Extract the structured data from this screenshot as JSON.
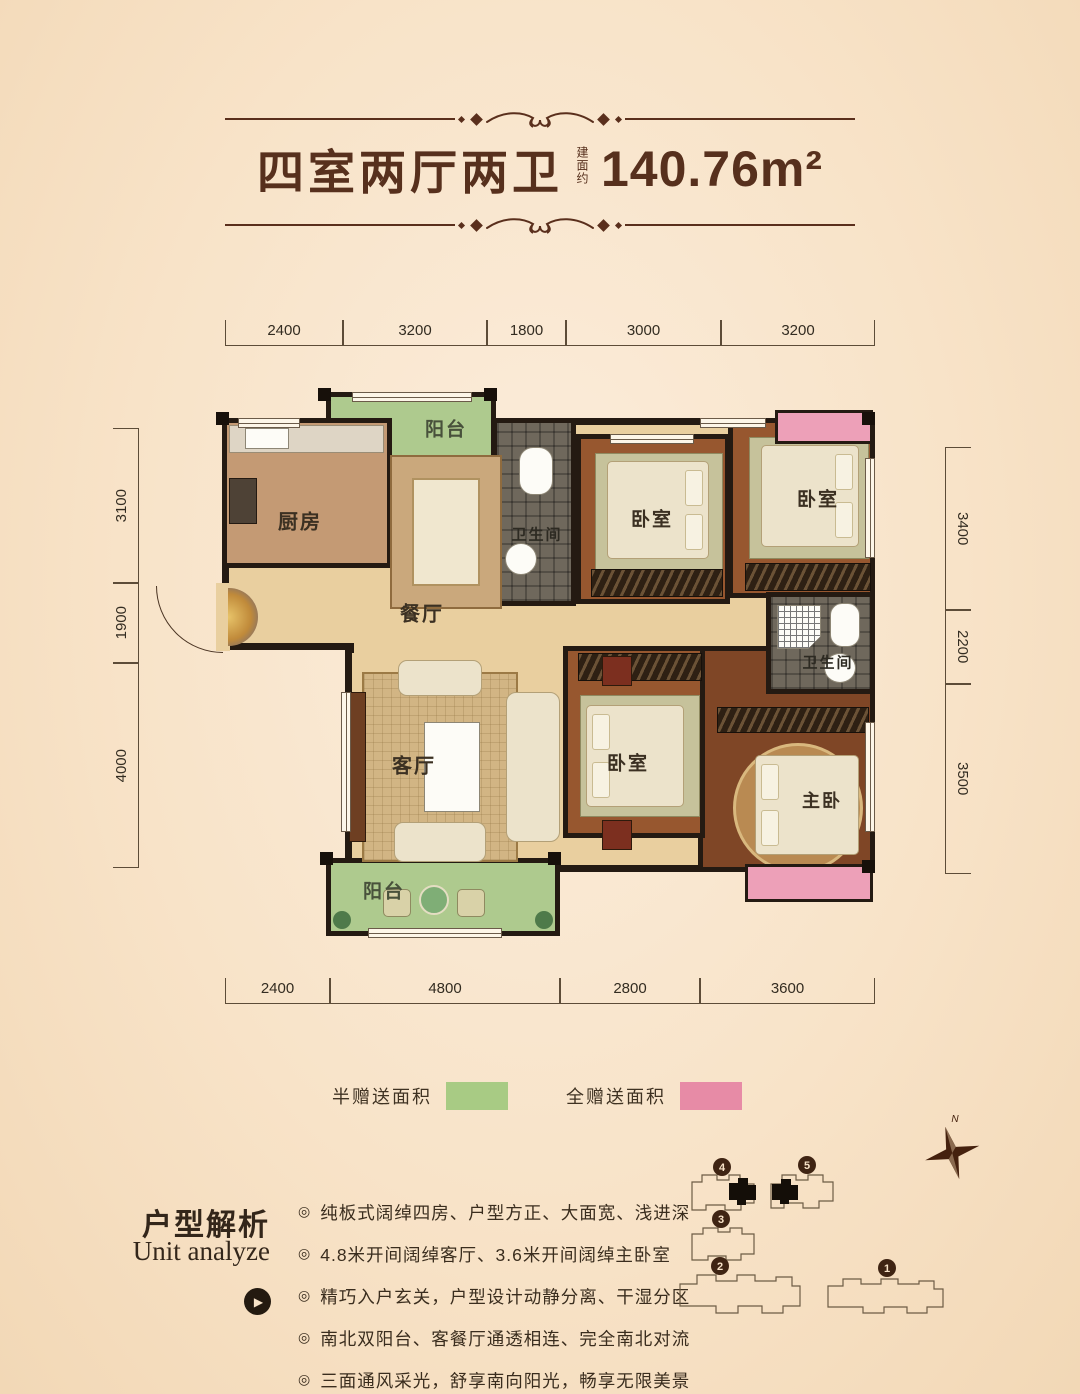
{
  "header": {
    "title_cn": "四室两厅两卫",
    "area_label": "建面约",
    "area_value": "140.76m²"
  },
  "dimensions": {
    "top": [
      "2400",
      "3200",
      "1800",
      "3000",
      "3200"
    ],
    "bottom": [
      "2400",
      "4800",
      "2800",
      "3600"
    ],
    "left": [
      "3100",
      "1900",
      "4000"
    ],
    "right": [
      "3400",
      "2200",
      "3500"
    ]
  },
  "rooms": {
    "balcony_top": "阳台",
    "kitchen": "厨房",
    "dining": "餐厅",
    "bathroom1": "卫生间",
    "bedroom1": "卧室",
    "bedroom2": "卧室",
    "living": "客厅",
    "bedroom3": "卧室",
    "bathroom2": "卫生间",
    "master_bedroom": "主卧",
    "balcony_bottom": "阳台"
  },
  "legend": {
    "half_gift_label": "半赠送面积",
    "half_gift_color": "#a8cb84",
    "full_gift_label": "全赠送面积",
    "full_gift_color": "#e78ba6"
  },
  "analysis": {
    "title_cn": "户型解析",
    "title_en": "Unit analyze",
    "bullet_icon": "◎",
    "bullets": [
      "纯板式阔绰四房、户型方正、大面宽、浅进深",
      "4.8米开间阔绰客厅、3.6米开间阔绰主卧室",
      "精巧入户玄关，户型设计动静分离、干湿分区",
      "南北双阳台、客餐厅通透相连、完全南北对流",
      "三面通风采光，舒享南向阳光，畅享无限美景"
    ]
  },
  "siteplan": {
    "north_label": "N",
    "building_numbers": [
      "4",
      "5",
      "3",
      "2",
      "1"
    ]
  },
  "colors": {
    "background": "#f8e3c8",
    "title_brown": "#57301d",
    "wall_dark": "#241a12",
    "floor_tan": "#e9cf9f",
    "bedroom_wood": "#97572f",
    "balcony_green": "#aeca8e",
    "gift_pink": "#eda0b8"
  }
}
